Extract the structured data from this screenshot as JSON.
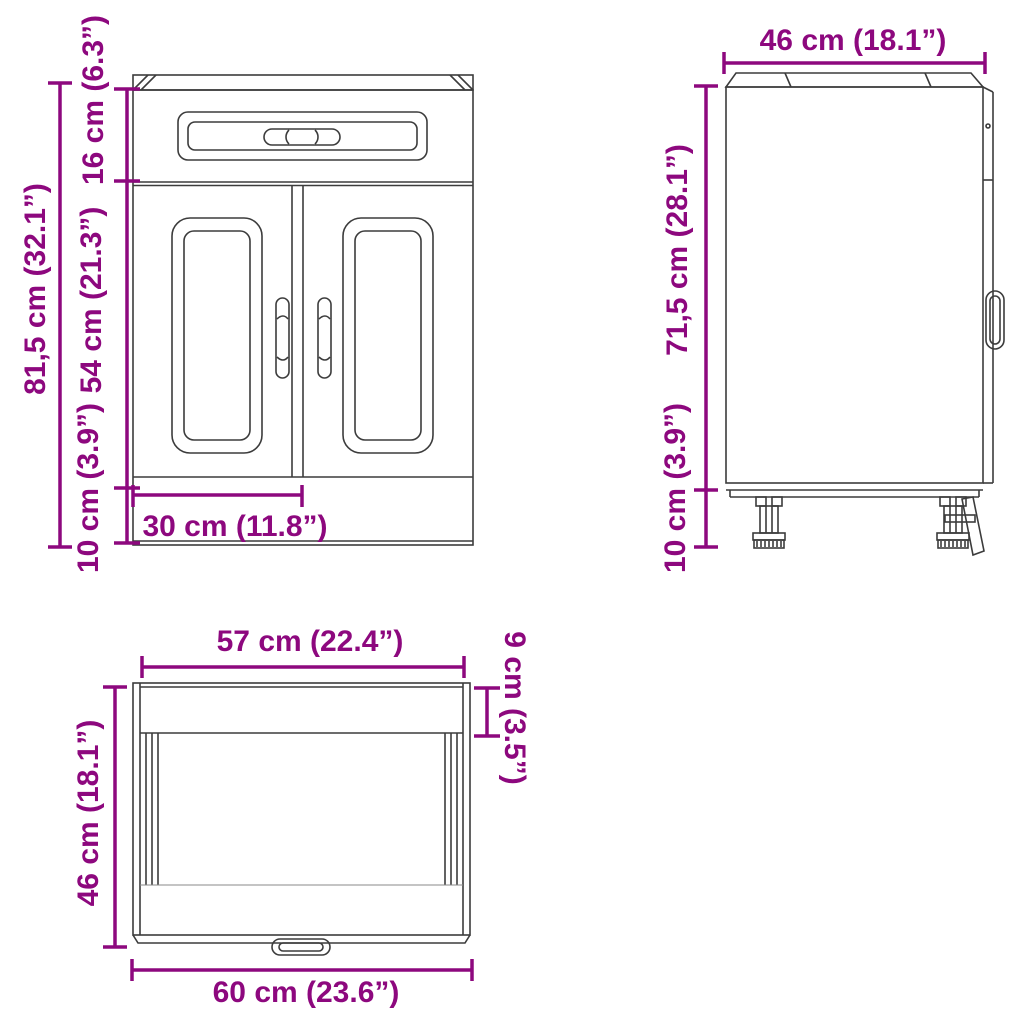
{
  "title": "Kitchen base cabinet dimension diagram",
  "colors": {
    "dimension_accent": "#8d087e",
    "drawing_line": "#3c3c3c",
    "background": "#ffffff"
  },
  "views": {
    "front": {
      "name": "front-view",
      "dimensions": {
        "total_height": "81,5 cm (32.1”)",
        "drawer_height": "16 cm (6.3”)",
        "door_height": "54 cm (21.3”)",
        "plinth_height": "10 cm (3.9”)",
        "door_width": "30 cm (11.8”)"
      }
    },
    "side": {
      "name": "side-view",
      "dimensions": {
        "depth": "46 cm (18.1”)",
        "body_height": "71,5 cm (28.1”)",
        "leg_height": "10 cm (3.9”)"
      }
    },
    "top": {
      "name": "top-view",
      "dimensions": {
        "inner_width": "57 cm (22.4”)",
        "countertop_depth": "9 cm (3.5”)",
        "depth": "46 cm (18.1”)",
        "total_width": "60 cm (23.6”)"
      }
    }
  }
}
